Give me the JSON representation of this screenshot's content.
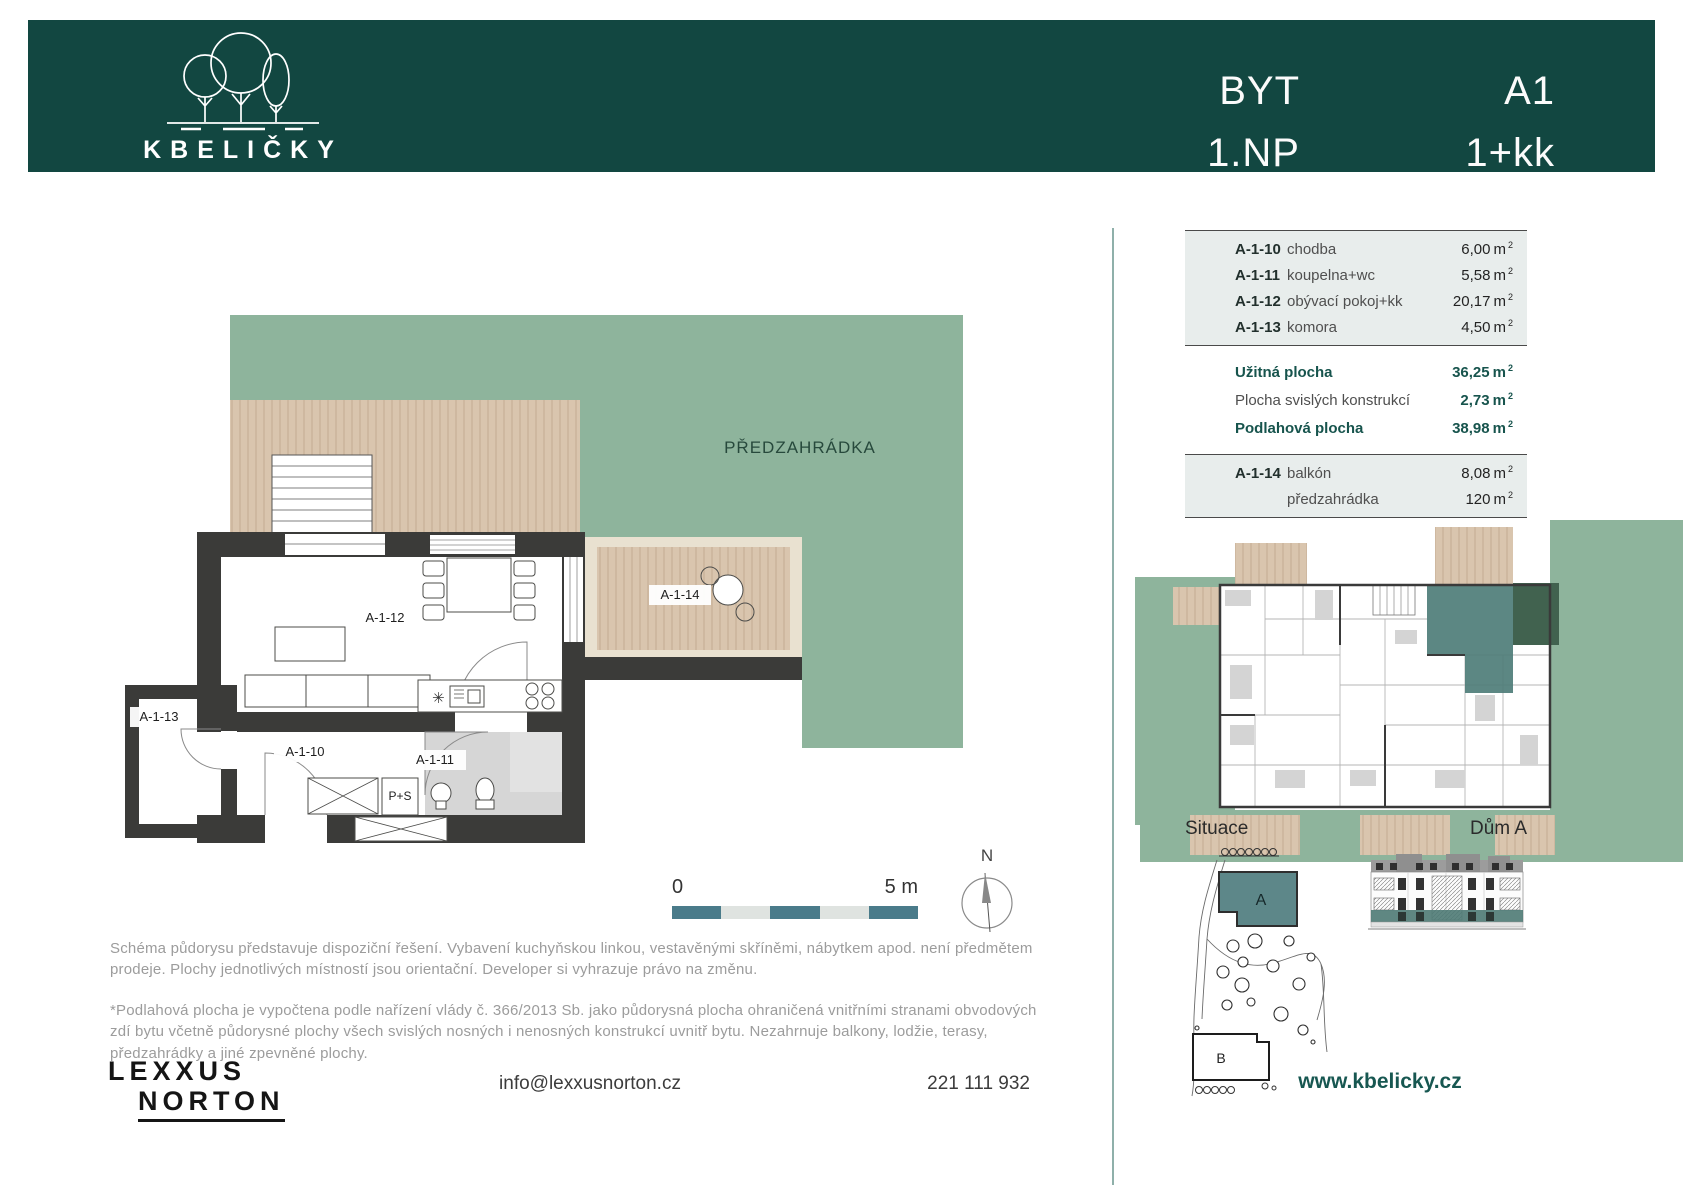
{
  "colors": {
    "header_bg": "#124741",
    "garden_green": "#8eb49c",
    "deck_tan": "#d9c5ae",
    "wall_dark": "#3b3b39",
    "accent_teal": "#17544d",
    "scale_teal": "#4a7b8a",
    "link_teal": "#175751"
  },
  "header": {
    "logo_text": "KBELIČKY",
    "unit_type_label": "BYT",
    "floor_label": "1.NP",
    "unit_id": "A1",
    "layout_label": "1+kk"
  },
  "floor_plan": {
    "garden_label": "PŘEDZAHRÁDKA",
    "labels": {
      "living": "A-1-12",
      "balcony": "A-1-14",
      "storage": "A-1-13",
      "hallway": "A-1-10",
      "bathroom": "A-1-11",
      "washer": "P+S"
    },
    "scale_start": "0",
    "scale_end": "5 m",
    "north_label": "N"
  },
  "area_table": {
    "rooms": [
      {
        "code": "A-1-10",
        "name": "chodba",
        "value": "6,00"
      },
      {
        "code": "A-1-11",
        "name": "koupelna+wc",
        "value": "5,58"
      },
      {
        "code": "A-1-12",
        "name": "obývací pokoj+kk",
        "value": "20,17"
      },
      {
        "code": "A-1-13",
        "name": "komora",
        "value": "4,50"
      }
    ],
    "summary": [
      {
        "label": "Užitná plocha",
        "value": "36,25"
      },
      {
        "label": "Plocha svislých konstrukcí",
        "value": "2,73"
      },
      {
        "label": "Podlahová plocha",
        "value": "38,98"
      }
    ],
    "exterior": [
      {
        "code": "A-1-14",
        "name": "balkón",
        "value": "8,08"
      },
      {
        "code": "",
        "name": "předzahrádka",
        "value": "120"
      }
    ],
    "unit": "m",
    "unit_sup": "2"
  },
  "right_panel": {
    "situace_label": "Situace",
    "house_label": "Dům A",
    "building_a": "A",
    "building_b": "B"
  },
  "disclaimer": {
    "para1": "Schéma půdorysu představuje dispoziční řešení. Vybavení kuchyňskou linkou, vestavěnými skříněmi, nábytkem apod. není předmětem prodeje. Plochy jednotlivých místností jsou orientační. Developer si vyhrazuje právo na změnu.",
    "para2": "*Podlahová plocha je vypočtena podle nařízení vlády č. 366/2013 Sb. jako půdorysná plocha ohraničená vnitřními stranami obvodových zdí bytu včetně půdorysné plochy všech svislých nosných i nenosných konstrukcí uvnitř bytu. Nezahrnuje balkony, lodžie, terasy, předzahrádky a jiné zpevněné plochy."
  },
  "footer": {
    "brand_line1": "LEXXUS",
    "brand_line2": "NORTON",
    "email": "info@lexxusnorton.cz",
    "phone": "221 111 932",
    "website": "www.kbelicky.cz"
  }
}
